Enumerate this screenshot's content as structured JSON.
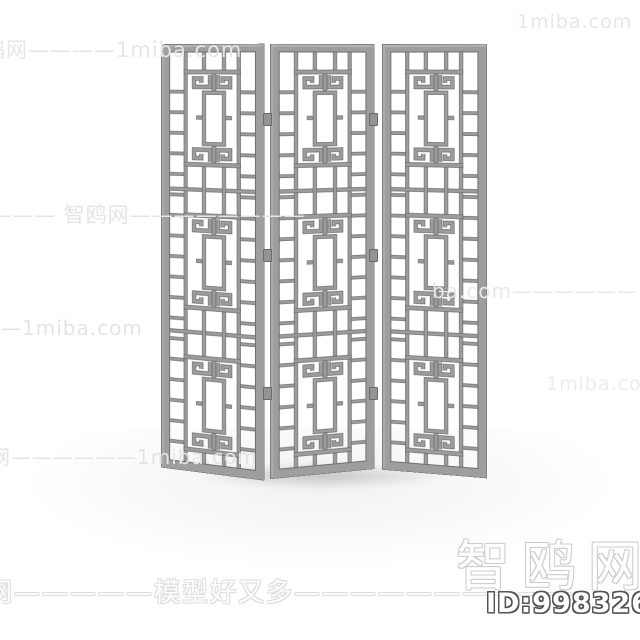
{
  "scene": {
    "object_label": "three-panel chinese lattice folding screen render",
    "panel_count": 3,
    "sections_per_panel": 3,
    "colors": {
      "background": "#ffffff",
      "frame_fill": "#9e9e9e",
      "bar_fill": "#9c9c9c",
      "edge": "#6d6d6d",
      "highlight": "#c6c6c6",
      "hinge_fill": "#949494"
    }
  },
  "watermarks": {
    "top_left": "鸥网————1miba.com",
    "top_right": "1miba.com ——————",
    "mid_left": "——— 智鸥网————————",
    "mid_right": "ba.com—————— 智鸥网",
    "left_tail": "————1miba.com",
    "left_bottom": "网——————1miba.com",
    "right_lower": "1miba.com ——————",
    "bottom_slogan": "网—————模型好又多——————————",
    "brand_large": "智鸥网",
    "model_id": "ID:998326062"
  }
}
